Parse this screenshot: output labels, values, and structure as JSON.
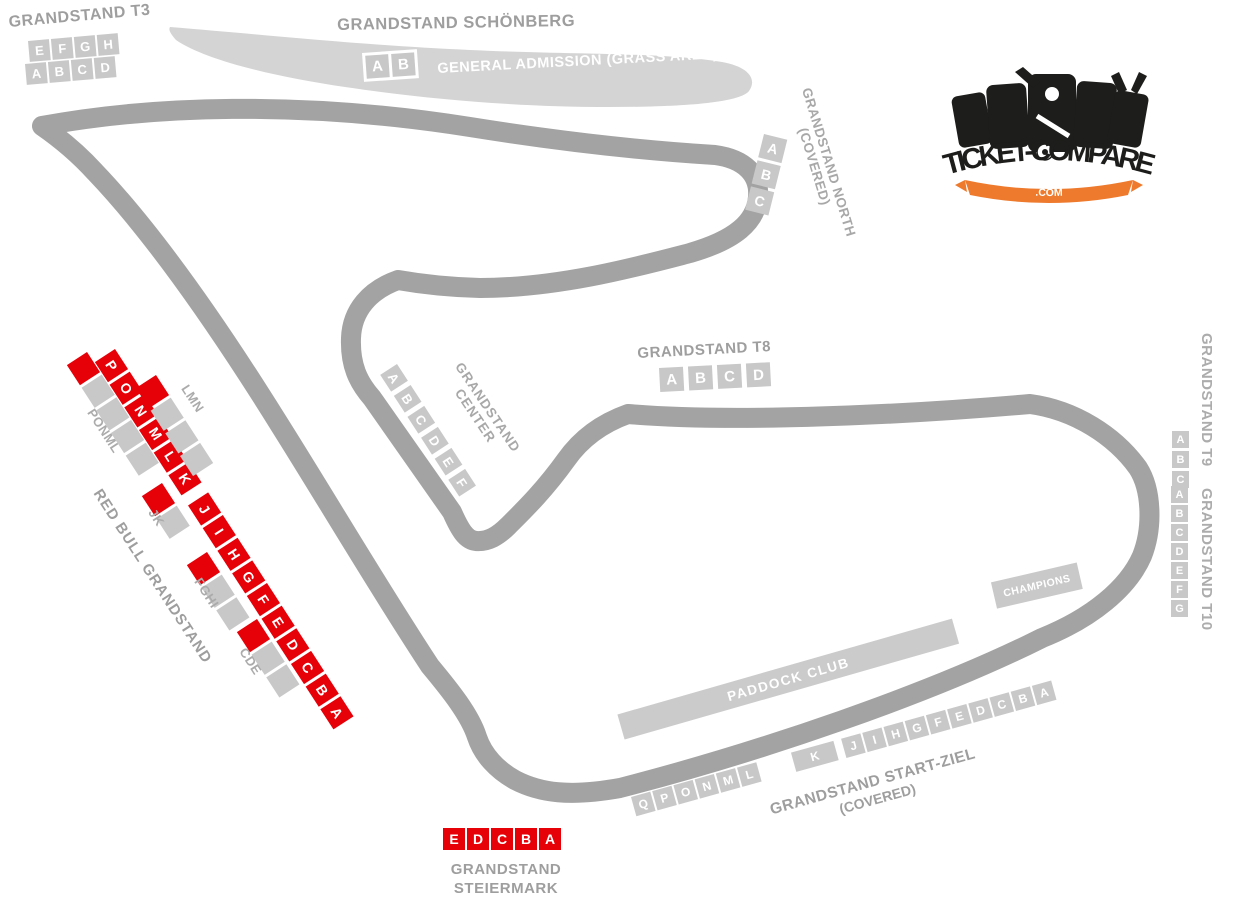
{
  "colors": {
    "track": "#a3a3a3",
    "grass_band": "#d4d4d4",
    "block_gray": "#c8c8c8",
    "block_red": "#e60008",
    "label_gray": "#9e9e9e",
    "logo_orange": "#ee7a2d",
    "logo_black": "#1d1d1b"
  },
  "logo": {
    "text": "TICKET-COMPARE",
    "tld": ".COM"
  },
  "stands": {
    "t3": {
      "label": "GRANDSTAND T3",
      "row_upper": [
        "E",
        "F",
        "G",
        "H"
      ],
      "row_lower": [
        "A",
        "B",
        "C",
        "D"
      ]
    },
    "schoenberg": {
      "label": "GRANDSTAND SCHÖNBERG",
      "blocks": [
        "A",
        "B"
      ],
      "area_label": "GENERAL ADMISSION (GRASS AREA)"
    },
    "north": {
      "label": "GRANDSTAND NORTH",
      "sublabel": "(COVERED)",
      "blocks": [
        "A",
        "B",
        "C"
      ]
    },
    "center": {
      "label": [
        "GRANDSTAND",
        "CENTER"
      ],
      "blocks": [
        "A",
        "B",
        "C",
        "D",
        "E",
        "F"
      ]
    },
    "t8": {
      "label": "GRANDSTAND T8",
      "blocks": [
        "A",
        "B",
        "C",
        "D"
      ]
    },
    "t9": {
      "label": "GRANDSTAND T9",
      "blocks": [
        "A",
        "B",
        "C"
      ]
    },
    "t10": {
      "label": "GRANDSTAND T10",
      "blocks": [
        "A",
        "B",
        "C",
        "D",
        "E",
        "F",
        "G"
      ]
    },
    "red_bull": {
      "label": "RED BULL GRANDSTAND",
      "blocks": [
        "P",
        "O",
        "N",
        "M",
        "L",
        "K",
        "J",
        "I",
        "H",
        "G",
        "F",
        "E",
        "D",
        "C",
        "B",
        "A"
      ],
      "tiers": [
        {
          "label": "PONML",
          "pattern": [
            "red",
            "gray",
            "gray",
            "gray",
            "gray"
          ]
        },
        {
          "label": "LMN",
          "pattern": [
            "red",
            "gray",
            "gray",
            "gray"
          ]
        },
        {
          "label": "JK",
          "pattern": [
            "red",
            "gray"
          ]
        },
        {
          "label": "FGHI",
          "pattern": [
            "red",
            "gray",
            "gray"
          ]
        },
        {
          "label": "CDE",
          "pattern": [
            "red",
            "gray",
            "gray"
          ]
        }
      ]
    },
    "paddock_club": {
      "label": "PADDOCK CLUB"
    },
    "champions": {
      "label": "CHAMPIONS"
    },
    "start_ziel": {
      "label": "GRANDSTAND START-ZIEL",
      "sublabel": "(COVERED)",
      "blocks": [
        "Q",
        "P",
        "O",
        "N",
        "M",
        "L",
        "K",
        "J",
        "I",
        "H",
        "G",
        "F",
        "E",
        "D",
        "C",
        "B",
        "A"
      ]
    },
    "steiermark": {
      "label": [
        "GRANDSTAND",
        "STEIERMARK"
      ],
      "blocks": [
        "E",
        "D",
        "C",
        "B",
        "A"
      ]
    }
  }
}
